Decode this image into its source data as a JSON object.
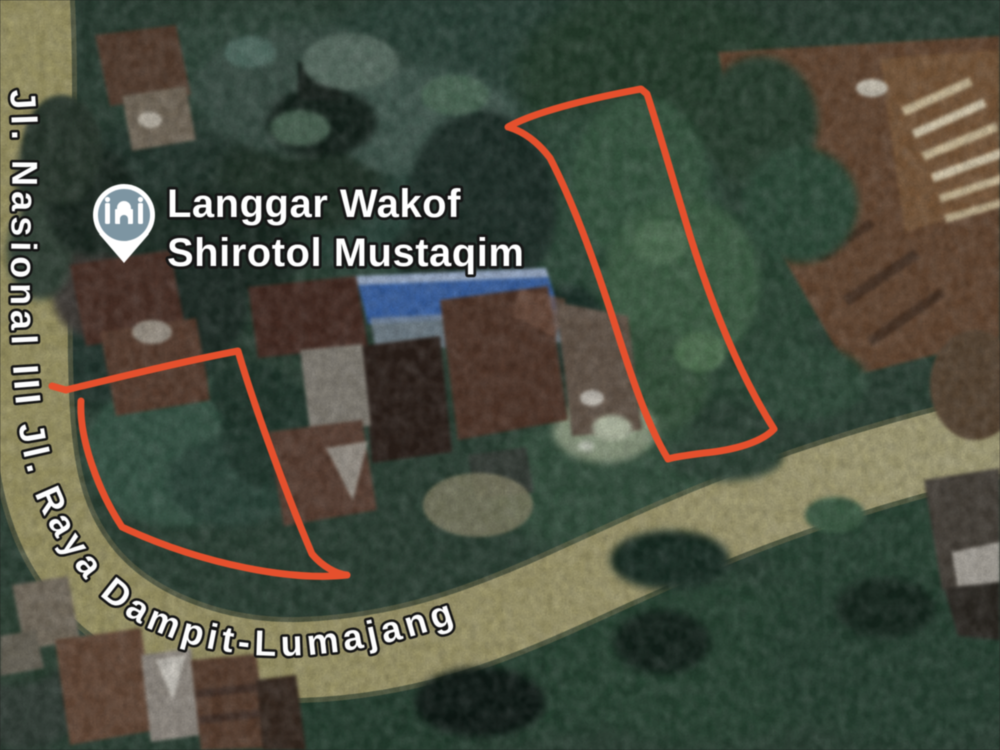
{
  "map": {
    "view_type": "satellite",
    "poi": {
      "name_line1": "Langgar Wakof",
      "name_line2": "Shirotol Mustaqim",
      "marker_icon": "mosque-place-of-worship-icon",
      "marker_circle_color": "#7d95a2",
      "marker_outline_color": "#ffffff"
    },
    "road": {
      "label": "Jl. Nasional III Jl. Raya Dampit-Lumajang",
      "surface_color": "#a7a06c"
    },
    "annotations": {
      "outline_color": "#e5502d",
      "plots": [
        {
          "id": "left-plot-outline",
          "location": "south-west of houses, along road bend"
        },
        {
          "id": "right-plot-outline",
          "location": "north-east wooded parcel"
        }
      ]
    }
  }
}
